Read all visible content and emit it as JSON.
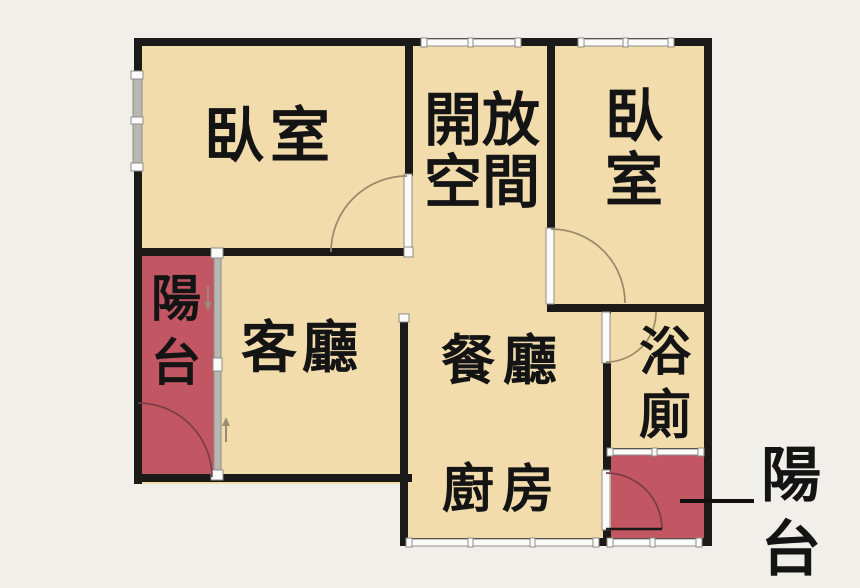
{
  "colors": {
    "background": "#f1efe9",
    "room_fill": "#f2dcac",
    "balcony_fill": "#c25763",
    "wall": "#1c1a18",
    "window_fill": "#fbfbf9",
    "window_frame": "#8e8c88",
    "glass": "#b9b7b2",
    "door_arc": "#9c8868",
    "balcony_arc": "#7a3d47",
    "door_leaf": "#1c1a18",
    "leader": "#111111",
    "arrow": "#9a8c72",
    "text": "#141414"
  },
  "labels": {
    "bedroom_left": "臥室",
    "open_space": "開放\n空間",
    "bedroom_right": "臥\n室",
    "balcony_left": "陽\n台",
    "living_room": "客廳",
    "dining_room": "餐廳",
    "bathroom": "浴\n廁",
    "kitchen": "廚房",
    "balcony_right": "陽\n台"
  }
}
